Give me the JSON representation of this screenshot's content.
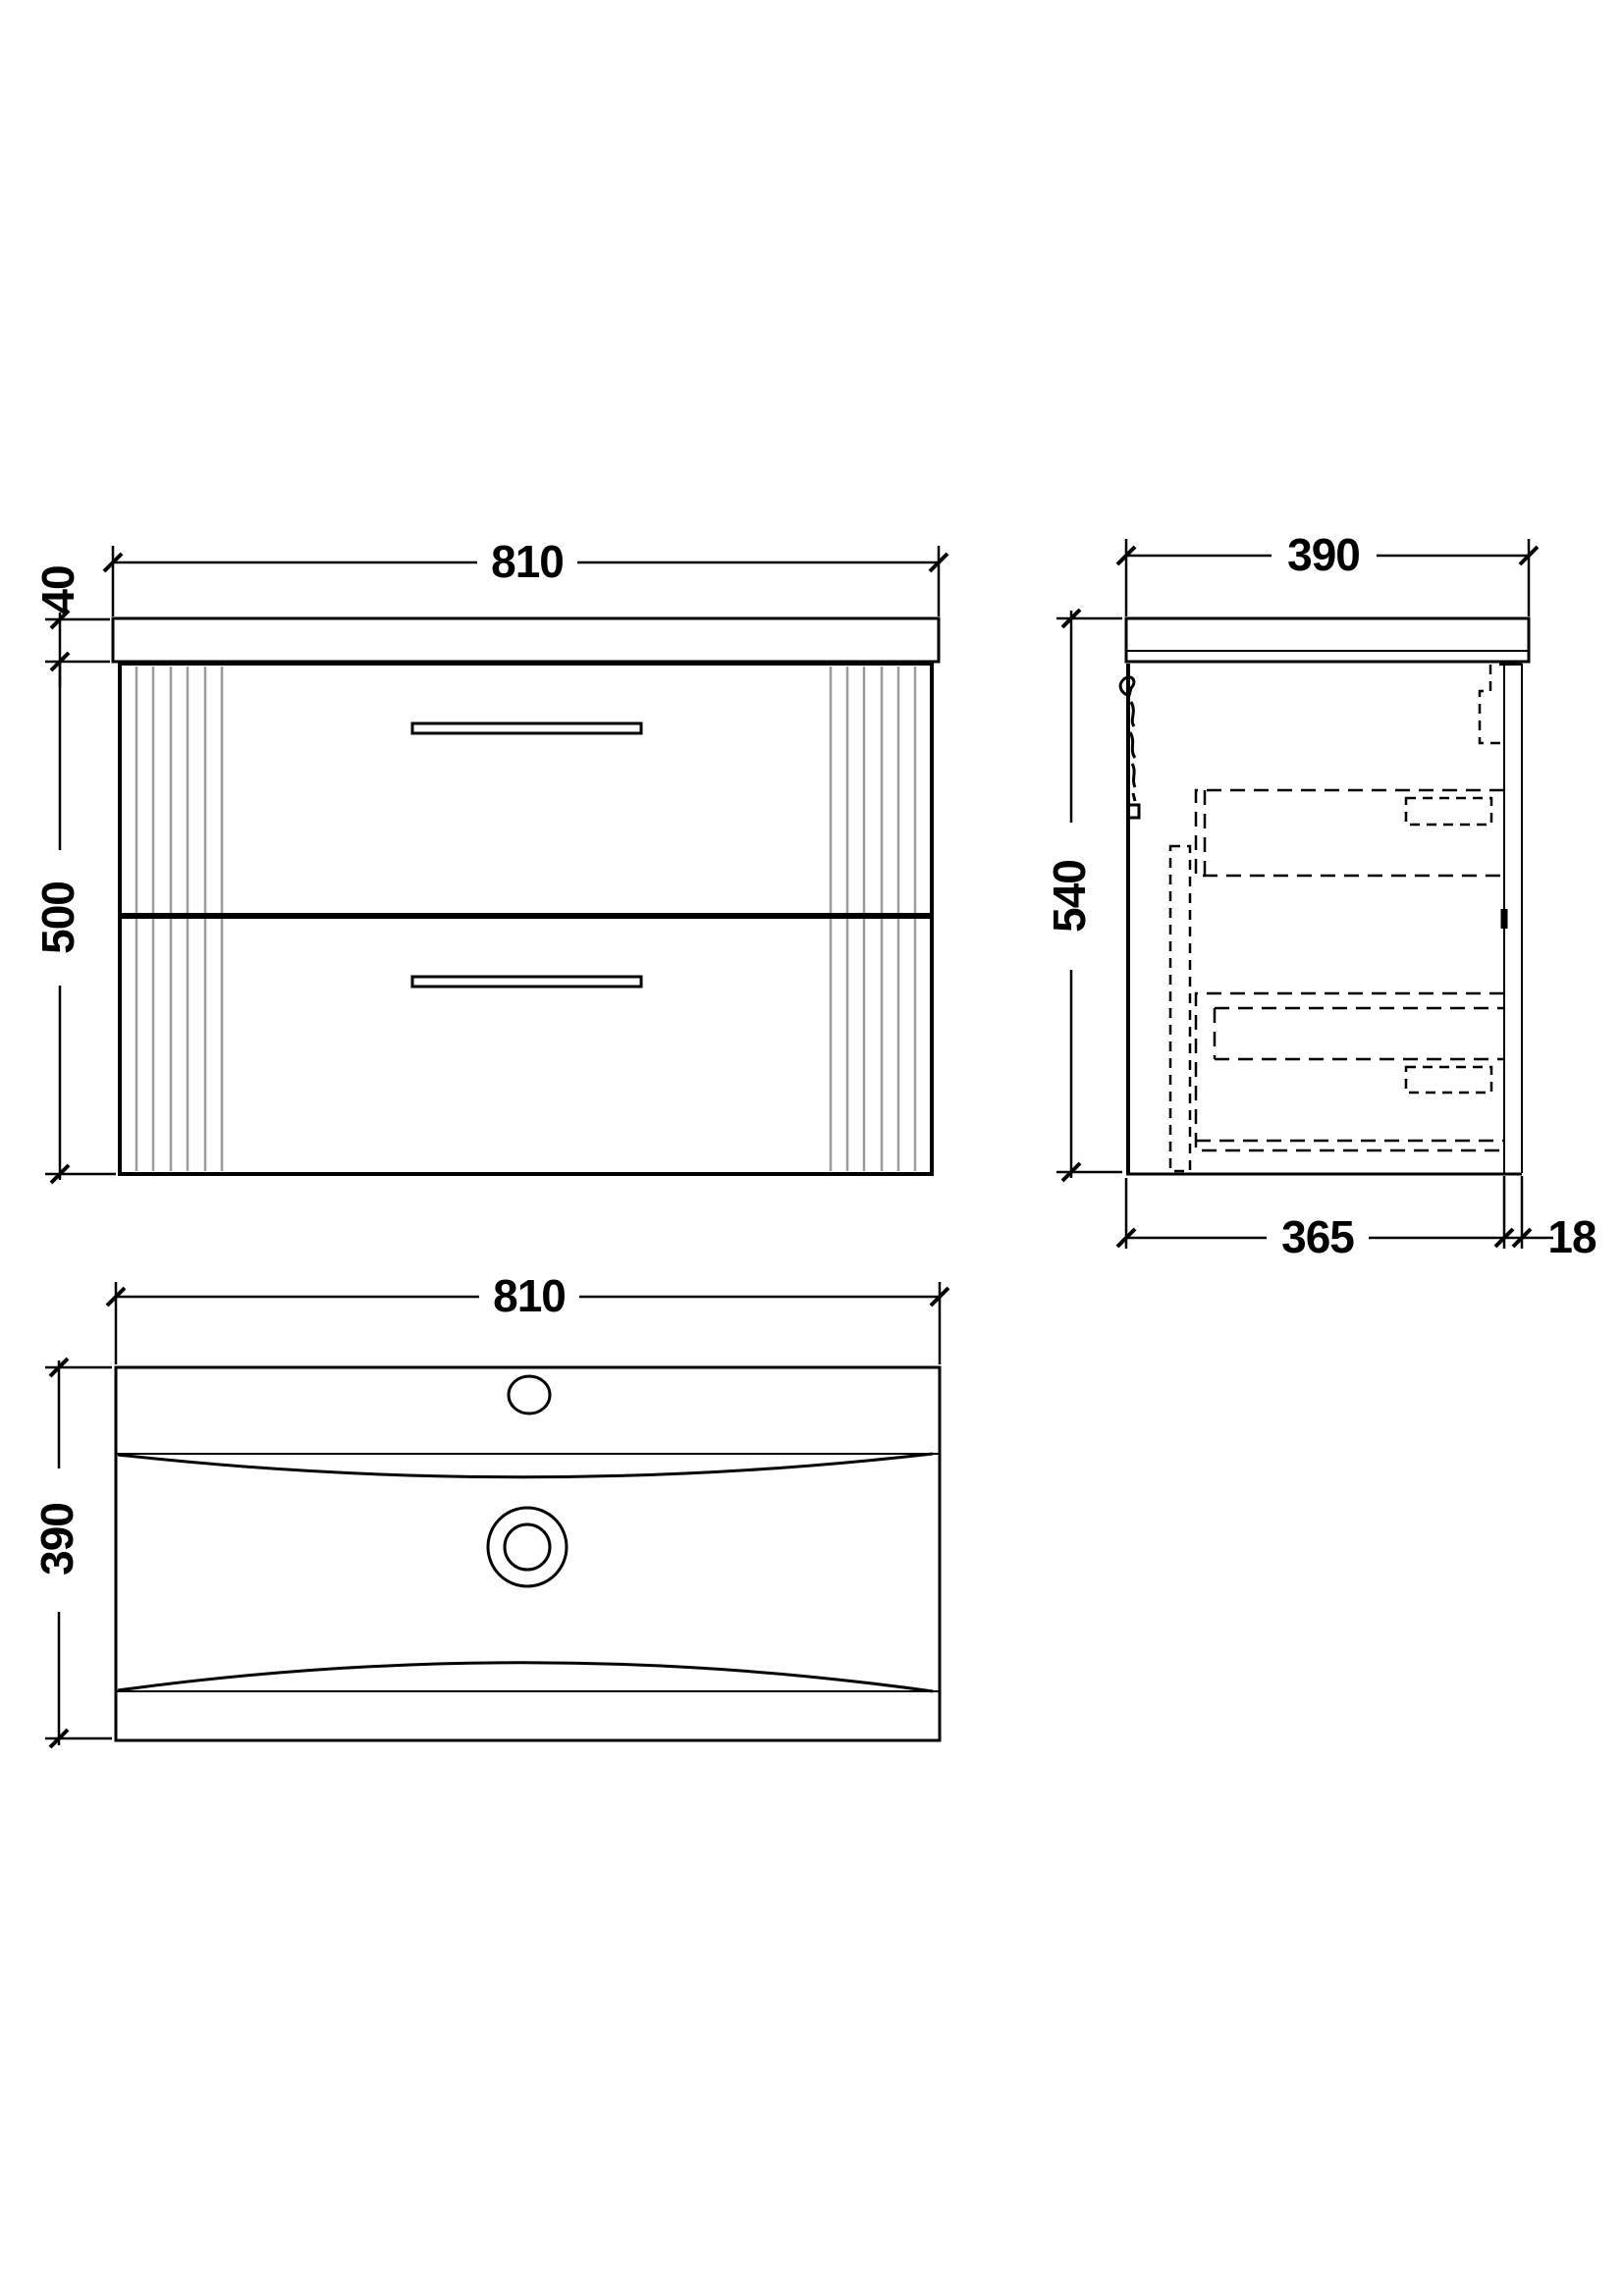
{
  "colors": {
    "line": "#000000",
    "flute": "#9b9b9b",
    "background": "#ffffff"
  },
  "drawing_type": "vanity-unit-technical-drawing",
  "views": {
    "front": {
      "width": "810",
      "worktop_thickness": "40",
      "cabinet_height": "500"
    },
    "side": {
      "overall_depth": "390",
      "overall_height": "540",
      "cabinet_depth": "365",
      "back_panel_thickness": "18"
    },
    "plan": {
      "width": "810",
      "depth": "390"
    }
  }
}
